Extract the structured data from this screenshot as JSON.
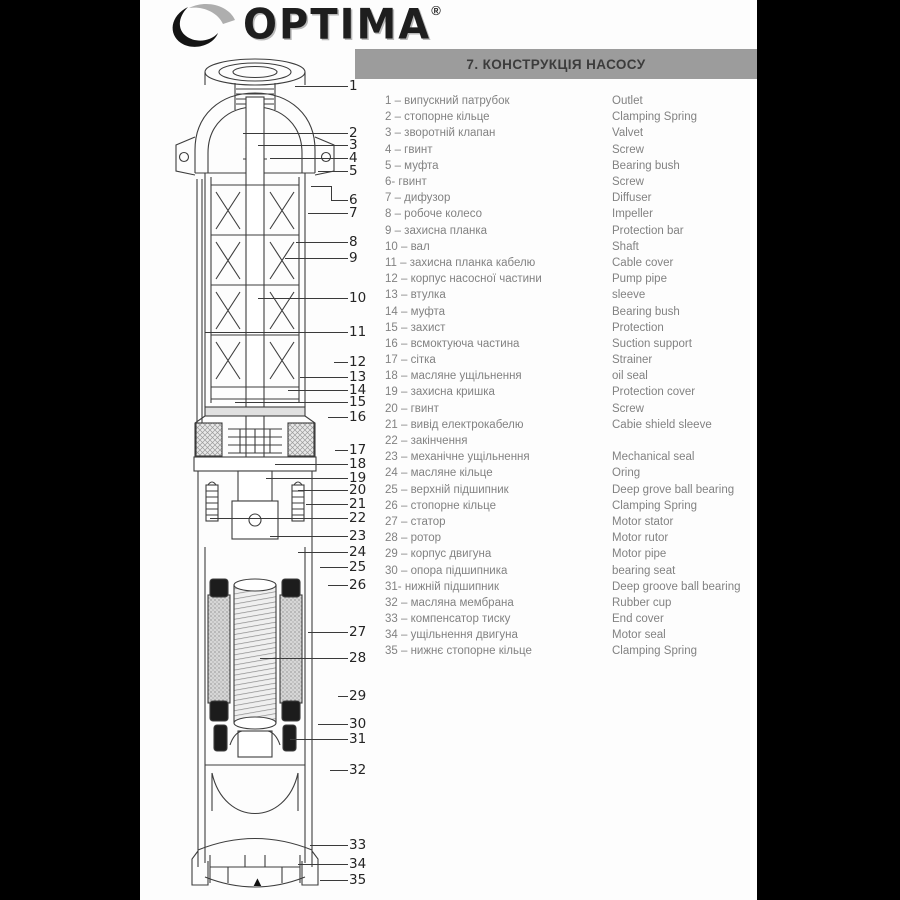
{
  "logo": {
    "text": "OPTIMA",
    "registered": "®",
    "icon": "crescent-swoosh-icon"
  },
  "header": {
    "title": "7. КОНСТРУКЦІЯ НАСОСУ",
    "bar_color": "#9c9c9c"
  },
  "parts_list": {
    "items": [
      {
        "num": "1",
        "ua": "випускний патрубок",
        "en": "Outlet"
      },
      {
        "num": "2",
        "ua": "стопорне кільце",
        "en": "Clamping Spring"
      },
      {
        "num": "3",
        "ua": "зворотній клапан",
        "en": "Valvet"
      },
      {
        "num": "4",
        "ua": "гвинт",
        "en": "Screw"
      },
      {
        "num": "5",
        "ua": "муфта",
        "en": "Bearing bush"
      },
      {
        "num": "6",
        "sep": "- ",
        "ua": "гвинт",
        "en": "Screw"
      },
      {
        "num": "7",
        "ua": "дифузор",
        "en": "Diffuser"
      },
      {
        "num": "8",
        "ua": "робоче колесо",
        "en": "Impeller"
      },
      {
        "num": "9",
        "ua": "захисна планка",
        "en": "Protection bar"
      },
      {
        "num": "10",
        "ua": "вал",
        "en": "Shaft"
      },
      {
        "num": "11",
        "ua": "захисна планка кабелю",
        "en": "Cable cover"
      },
      {
        "num": "12",
        "ua": "корпус насосної частини",
        "en": "Pump pipe"
      },
      {
        "num": "13",
        "ua": "втулка",
        "en": "sleeve"
      },
      {
        "num": "14",
        "ua": "муфта",
        "en": "Bearing bush"
      },
      {
        "num": "15",
        "ua": "захист",
        "en": "Protection"
      },
      {
        "num": "16",
        "ua": "всмоктуюча частина",
        "en": "Suction support"
      },
      {
        "num": "17",
        "ua": "сітка",
        "en": "Strainer"
      },
      {
        "num": "18",
        "ua": "масляне ущільнення",
        "en": "oil seal"
      },
      {
        "num": "19",
        "ua": "захисна кришка",
        "en": "Protection cover"
      },
      {
        "num": "20",
        "ua": "гвинт",
        "en": "Screw"
      },
      {
        "num": "21",
        "ua": "вивід електрокабелю",
        "en": "Cabie shield sleeve"
      },
      {
        "num": "22",
        "ua": "закінчення",
        "en": ""
      },
      {
        "num": "23",
        "ua": "механічне ущільнення",
        "en": "Mechanical seal"
      },
      {
        "num": "24",
        "ua": "масляне кільце",
        "en": "Oring"
      },
      {
        "num": "25",
        "ua": "верхній підшипник",
        "en": "Deep grove ball bearing"
      },
      {
        "num": "26",
        "ua": "стопорне кільце",
        "en": "Clamping Spring"
      },
      {
        "num": "27",
        "ua": "статор",
        "en": "Motor stator"
      },
      {
        "num": "28",
        "ua": "ротор",
        "en": "Motor rutor"
      },
      {
        "num": "29",
        "ua": "корпус двигуна",
        "en": "Motor pipe"
      },
      {
        "num": "30",
        "ua": "опора підшипника",
        "en": "bearing seat"
      },
      {
        "num": "31",
        "sep": "- ",
        "ua": "нижній підшипник",
        "en": "Deep groove ball bearing"
      },
      {
        "num": "32",
        "ua": "масляна мембрана",
        "en": "Rubber cup"
      },
      {
        "num": "33",
        "ua": "компенсатор тиску",
        "en": "End cover"
      },
      {
        "num": "34",
        "ua": "ущільнення двигуна",
        "en": "Motor seal"
      },
      {
        "num": "35",
        "ua": "нижнє стопорне кільце",
        "en": "Clamping Spring"
      }
    ]
  },
  "diagram": {
    "pointer": "▲",
    "callouts": [
      {
        "n": "1",
        "y": 86,
        "lx": 295
      },
      {
        "n": "2",
        "y": 133,
        "lx": 243
      },
      {
        "n": "3",
        "y": 145,
        "lx": 258
      },
      {
        "n": "4",
        "y": 158,
        "lx": 270
      },
      {
        "n": "5",
        "y": 171,
        "lx": 318
      },
      {
        "n": "6",
        "y": 200,
        "lx": 311,
        "bendy": 186,
        "bendx": 331
      },
      {
        "n": "7",
        "y": 213,
        "lx": 308
      },
      {
        "n": "8",
        "y": 242,
        "lx": 296
      },
      {
        "n": "9",
        "y": 258,
        "lx": 285
      },
      {
        "n": "10",
        "y": 298,
        "lx": 258
      },
      {
        "n": "11",
        "y": 332,
        "lx": 205
      },
      {
        "n": "12",
        "y": 362,
        "lx": 334
      },
      {
        "n": "13",
        "y": 377,
        "lx": 300
      },
      {
        "n": "14",
        "y": 390,
        "lx": 288
      },
      {
        "n": "15",
        "y": 402,
        "lx": 235
      },
      {
        "n": "16",
        "y": 417,
        "lx": 328
      },
      {
        "n": "17",
        "y": 450,
        "lx": 335
      },
      {
        "n": "18",
        "y": 464,
        "lx": 275
      },
      {
        "n": "19",
        "y": 478,
        "lx": 266
      },
      {
        "n": "20",
        "y": 490,
        "lx": 298
      },
      {
        "n": "21",
        "y": 504,
        "lx": 306
      },
      {
        "n": "22",
        "y": 518,
        "lx": 210
      },
      {
        "n": "23",
        "y": 536,
        "lx": 270
      },
      {
        "n": "24",
        "y": 552,
        "lx": 298
      },
      {
        "n": "25",
        "y": 567,
        "lx": 320
      },
      {
        "n": "26",
        "y": 585,
        "lx": 328
      },
      {
        "n": "27",
        "y": 632,
        "lx": 308
      },
      {
        "n": "28",
        "y": 658,
        "lx": 260
      },
      {
        "n": "29",
        "y": 696,
        "lx": 338
      },
      {
        "n": "30",
        "y": 724,
        "lx": 318
      },
      {
        "n": "31",
        "y": 739,
        "lx": 290
      },
      {
        "n": "32",
        "y": 770,
        "lx": 330
      },
      {
        "n": "33",
        "y": 845,
        "lx": 310
      },
      {
        "n": "34",
        "y": 864,
        "lx": 298
      },
      {
        "n": "35",
        "y": 880,
        "lx": 320
      }
    ]
  }
}
